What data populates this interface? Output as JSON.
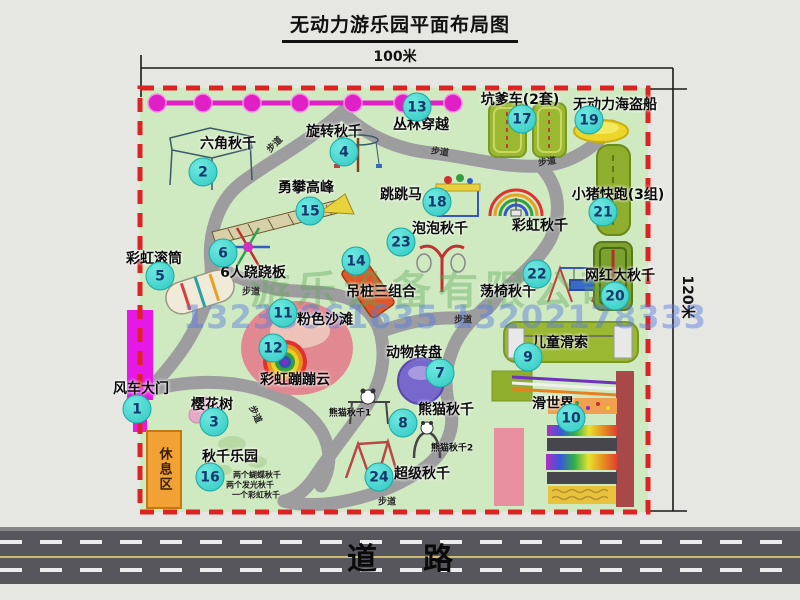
{
  "title": "无动力游乐园平面布局图",
  "dimensions": {
    "width": "100米",
    "height": "120米"
  },
  "road": {
    "label": "道路"
  },
  "rest_area": {
    "label": "休息区"
  },
  "watermark": {
    "company": "游乐设备有限公司",
    "phone": "13233861635 13202178333"
  },
  "walkway_label": "步道",
  "extra_labels": {
    "rainbow_swing": "彩虹秋千",
    "panda_swing_1": "熊猫秋千1",
    "panda_swing_2": "熊猫秋千2",
    "swing_park_note_1": "两个蝴蝶秋千",
    "swing_park_note_2": "两个发光秋千",
    "swing_park_note_3": "一个彩虹秋千"
  },
  "attractions": [
    {
      "num": "1",
      "label": "风车大门"
    },
    {
      "num": "2",
      "label": "六角秋千"
    },
    {
      "num": "3",
      "label": "樱花树"
    },
    {
      "num": "4",
      "label": "旋转秋千"
    },
    {
      "num": "5",
      "label": "彩虹滚筒"
    },
    {
      "num": "6",
      "label": "6人跷跷板"
    },
    {
      "num": "7",
      "label": "动物转盘"
    },
    {
      "num": "8",
      "label": "熊猫秋千"
    },
    {
      "num": "9",
      "label": "儿童滑索"
    },
    {
      "num": "10",
      "label": "滑世界"
    },
    {
      "num": "11",
      "label": "粉色沙滩"
    },
    {
      "num": "12",
      "label": "彩虹蹦蹦云"
    },
    {
      "num": "13",
      "label": "丛林穿越"
    },
    {
      "num": "14",
      "label": "吊桩三组合"
    },
    {
      "num": "15",
      "label": "勇攀高峰"
    },
    {
      "num": "16",
      "label": "秋千乐园"
    },
    {
      "num": "17",
      "label": "坑爹车(2套)"
    },
    {
      "num": "18",
      "label": "跳跳马"
    },
    {
      "num": "19",
      "label": "无动力海盗船"
    },
    {
      "num": "20",
      "label": "网红大秋千"
    },
    {
      "num": "21",
      "label": "小猪快跑(3组)"
    },
    {
      "num": "22",
      "label": "荡椅秋千"
    },
    {
      "num": "23",
      "label": "泡泡秋千"
    },
    {
      "num": "24",
      "label": "超级秋千"
    }
  ],
  "colors": {
    "park_green": "#cfe9c1",
    "border_red": "#dd2222",
    "marker_cyan": "#2fc9c2",
    "zipline_magenta": "#e020c6",
    "road_gray": "#56565c",
    "rest_area_orange": "#f2a235"
  }
}
